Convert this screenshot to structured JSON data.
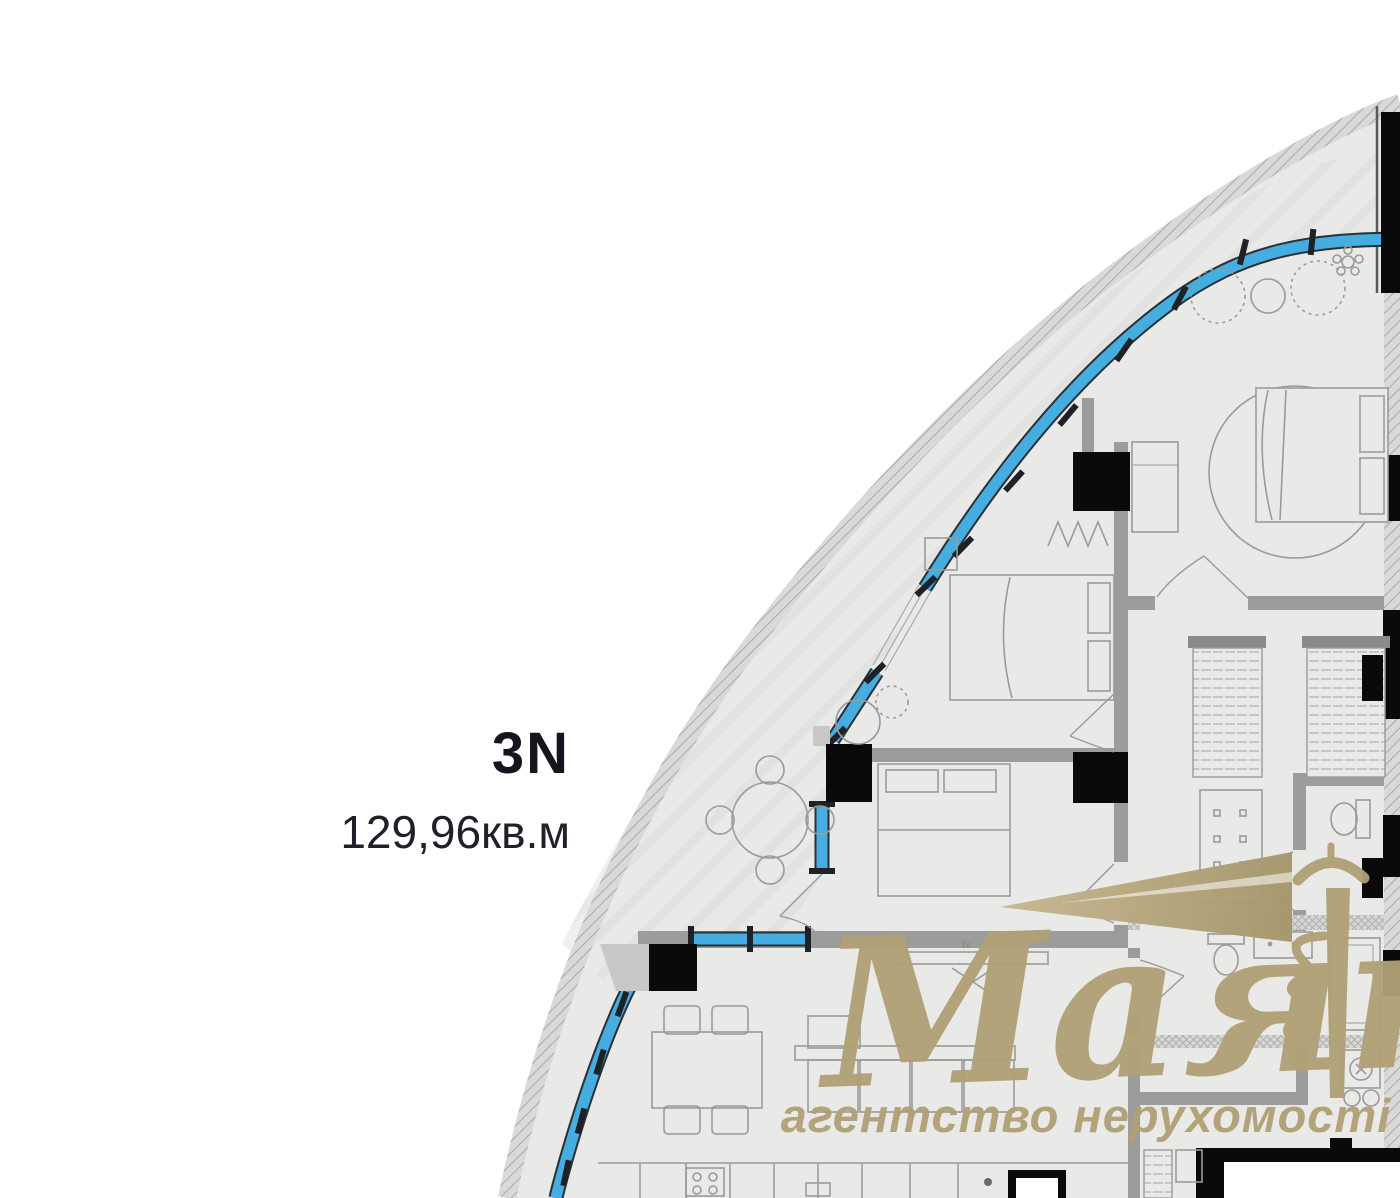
{
  "plan": {
    "unit_label": "3N",
    "area_label": "129,96кв.м",
    "tv_label": "tv"
  },
  "watermark": {
    "brand": "Маяк",
    "tagline": "агентство нерухомості",
    "color": "#b0a077"
  },
  "colors": {
    "window_blue": "#46ade0",
    "floor_gray": "#e9e9e8",
    "wall_gray": "#9c9c9a",
    "column_black": "#0a0a0a",
    "outer_band": "#d4d4d2",
    "label_dark": "#15151d"
  }
}
